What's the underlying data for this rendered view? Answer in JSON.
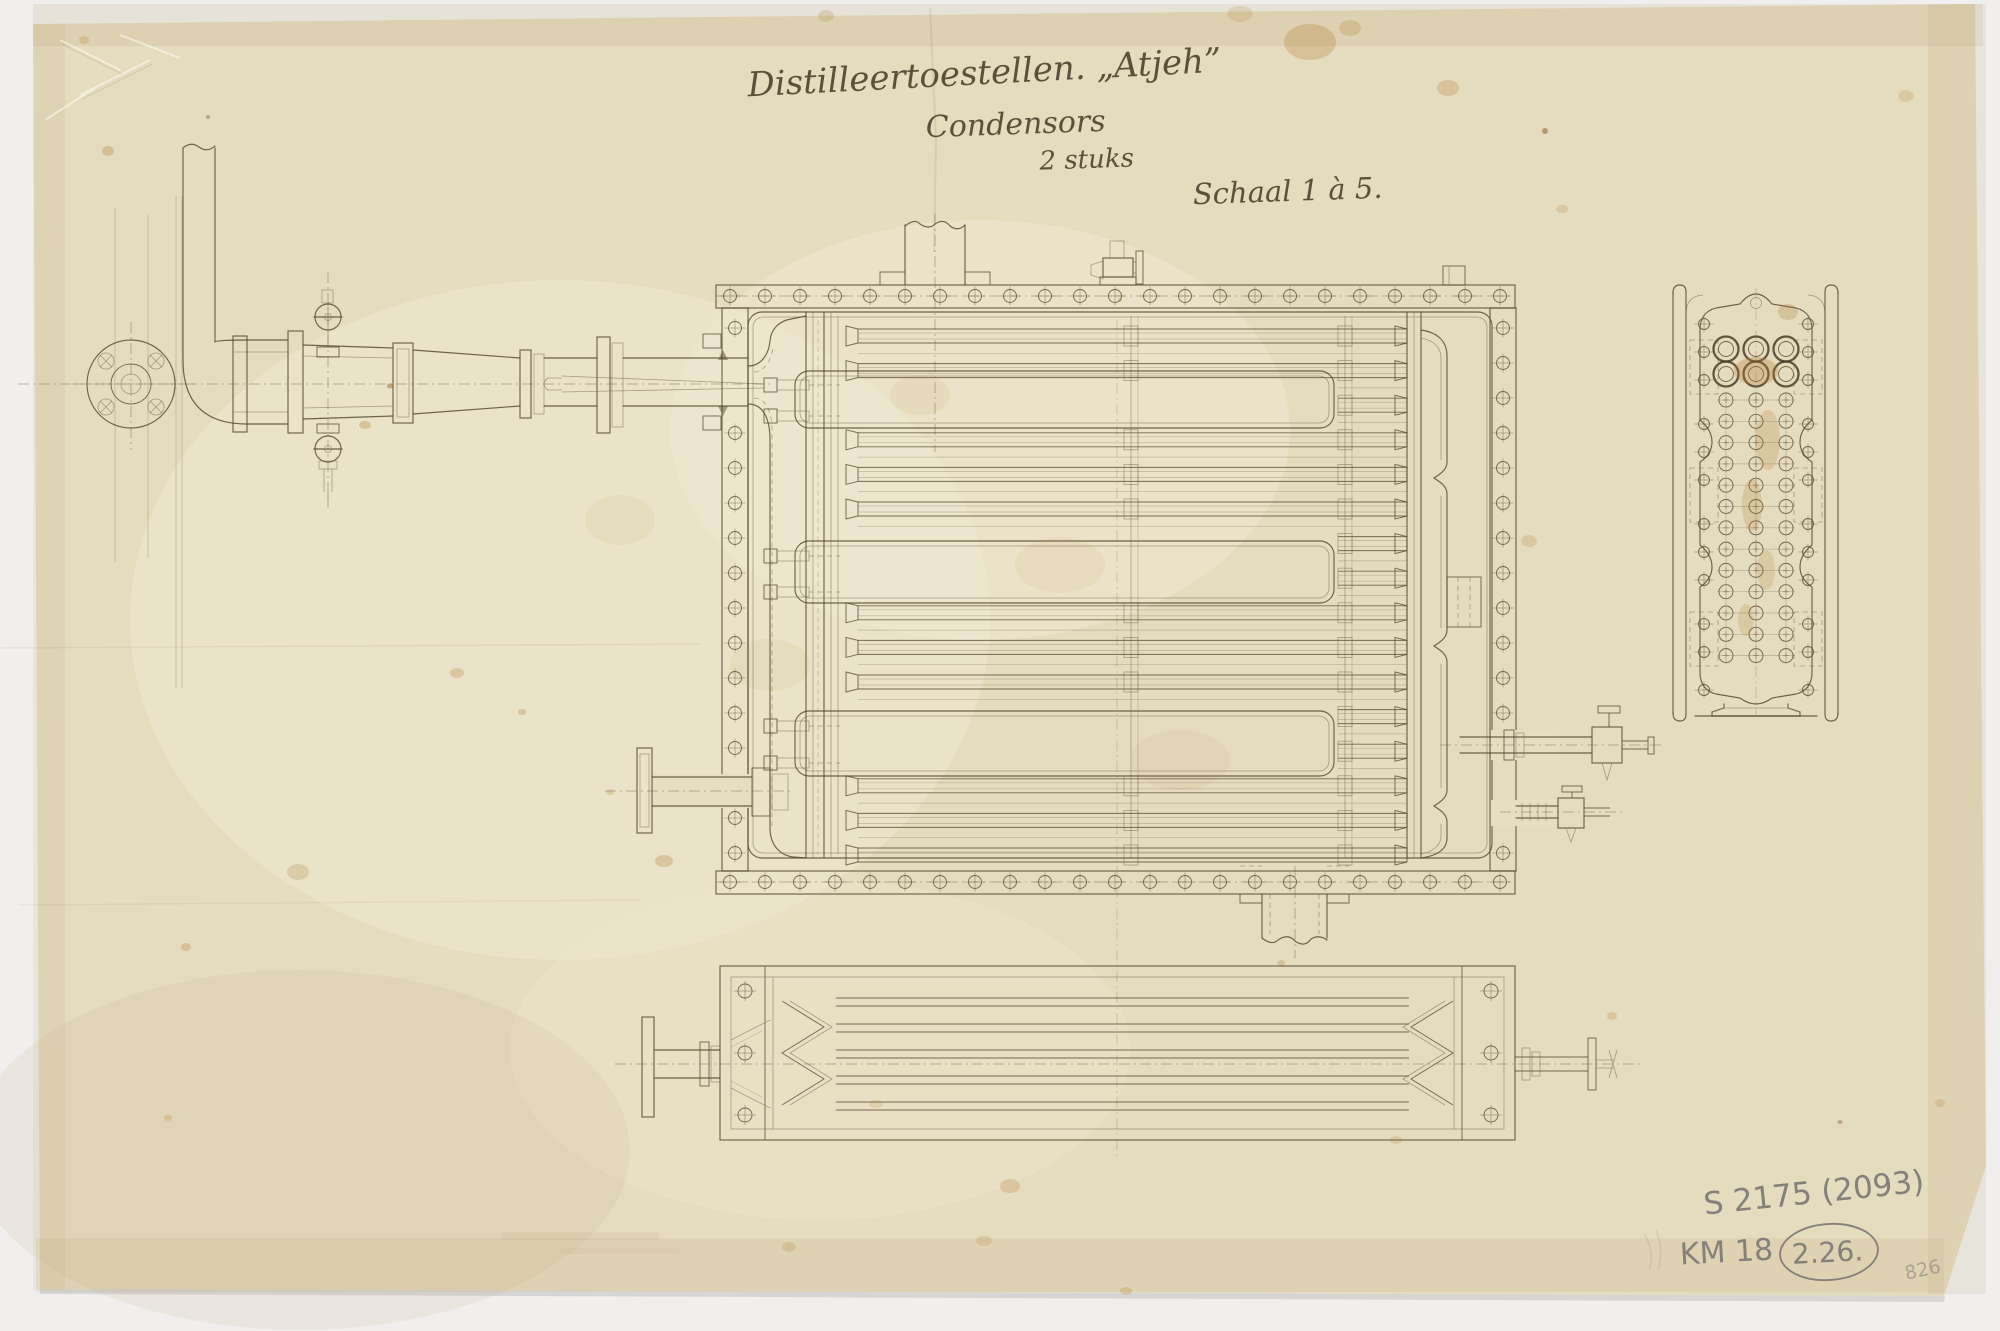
{
  "document": {
    "kind": "scanned technical drawing, aged paper",
    "title_line1": "Distilleertoestellen. „Atjeh”",
    "title_line2": "Condensors",
    "title_line3": "2 stuks",
    "scale_note": "Schaal 1 à 5.",
    "annotations": {
      "inventory_number": "S 2175 (2093)",
      "collection_mark": "KM 18",
      "circled_mark": "2.26.",
      "corner_number": "826"
    }
  },
  "colors": {
    "background": "#f0efed",
    "paper": "#e5dbbf",
    "ink": "#584a33",
    "ink_fine": "#6f6049",
    "pencil": "#84807a",
    "stain": "#b07a2e"
  },
  "drawing": {
    "flange_bolts": {
      "x0": 730,
      "step": 35,
      "count": 23,
      "y_top": 296,
      "y_bottom": 882,
      "r": 6.5
    },
    "wall_bolts": {
      "left_x": 735,
      "right_x": 1503,
      "r": 6.5,
      "left_ys": [
        328,
        433,
        468,
        503,
        538,
        573,
        608,
        643,
        678,
        713,
        748,
        818,
        853
      ],
      "right_ys": [
        328,
        363,
        398,
        433,
        468,
        503,
        538,
        573,
        608,
        643,
        678,
        713,
        853
      ]
    },
    "tubes": {
      "x0": 858,
      "x1": 1407,
      "y0": 336,
      "step": 34.6,
      "count": 16,
      "half_w": 7,
      "right_seg_x": 1338
    },
    "baffles": [
      [
        795,
        371,
        539,
        57
      ],
      [
        795,
        541,
        539,
        62
      ],
      [
        795,
        711,
        539,
        65
      ]
    ],
    "supports": {
      "cols": [
        1131,
        1345
      ]
    },
    "end_view": {
      "cols": [
        1726,
        1756,
        1786
      ],
      "big_rows": [
        349,
        374
      ],
      "big_r": 12.5,
      "big_r2": 7.5,
      "small_row_y0": 400,
      "small_row_step": 21.3,
      "small_rows": 13,
      "small_r": 7,
      "side_x": [
        1704,
        1808
      ],
      "side_ys": [
        324,
        352,
        380,
        424,
        452,
        480,
        524,
        552,
        580,
        624,
        652,
        690
      ],
      "pads_y": [
        [
          340,
          394
        ],
        [
          468,
          522
        ],
        [
          612,
          666
        ]
      ]
    },
    "plan": {
      "tube_pairs": [
        [
          998,
          1006
        ],
        [
          1024,
          1032
        ],
        [
          1050,
          1058
        ],
        [
          1076,
          1084
        ],
        [
          1102,
          1110
        ]
      ],
      "x0": 836,
      "x1": 1409,
      "bolts": [
        [
          745,
          991
        ],
        [
          745,
          1053
        ],
        [
          745,
          1115
        ],
        [
          1491,
          991
        ],
        [
          1491,
          1053
        ],
        [
          1491,
          1115
        ]
      ]
    },
    "stains": [
      [
        1310,
        42,
        26,
        18,
        0.28
      ],
      [
        1350,
        28,
        11,
        8,
        0.22
      ],
      [
        1240,
        14,
        13,
        8,
        0.18
      ],
      [
        826,
        16,
        8,
        6,
        0.2
      ],
      [
        1448,
        88,
        11,
        8,
        0.26
      ],
      [
        1906,
        96,
        8,
        6,
        0.18
      ],
      [
        1545,
        131,
        3,
        3,
        0.5
      ],
      [
        108,
        151,
        6,
        5,
        0.3
      ],
      [
        84,
        40,
        5,
        4,
        0.22
      ],
      [
        365,
        425,
        6,
        4,
        0.3
      ],
      [
        390,
        386,
        3,
        2.5,
        0.45
      ],
      [
        457,
        673,
        7,
        5,
        0.26
      ],
      [
        522,
        712,
        4,
        3,
        0.3
      ],
      [
        298,
        872,
        11,
        8,
        0.22
      ],
      [
        664,
        861,
        9,
        6,
        0.28
      ],
      [
        610,
        792,
        4,
        3,
        0.2
      ],
      [
        186,
        947,
        5,
        4,
        0.28
      ],
      [
        168,
        1118,
        4,
        3,
        0.22
      ],
      [
        1010,
        1186,
        10,
        7,
        0.24
      ],
      [
        789,
        1247,
        7,
        5,
        0.2
      ],
      [
        1126,
        1291,
        6,
        4,
        0.22
      ],
      [
        984,
        1241,
        8,
        5,
        0.18
      ],
      [
        876,
        1104,
        7,
        4,
        0.16
      ],
      [
        1281,
        963,
        4,
        3,
        0.24
      ],
      [
        1396,
        1140,
        6,
        4,
        0.18
      ],
      [
        1612,
        1016,
        5,
        4,
        0.2
      ],
      [
        1529,
        541,
        8,
        6,
        0.2
      ],
      [
        1562,
        209,
        6,
        4,
        0.18
      ],
      [
        1756,
        371,
        22,
        14,
        0.3
      ],
      [
        1768,
        440,
        12,
        30,
        0.2
      ],
      [
        1752,
        505,
        10,
        26,
        0.2
      ],
      [
        1766,
        570,
        9,
        20,
        0.18
      ],
      [
        1746,
        620,
        8,
        16,
        0.18
      ],
      [
        1788,
        312,
        10,
        8,
        0.25
      ],
      [
        1840,
        1122,
        2.5,
        2,
        0.4
      ],
      [
        1940,
        1103,
        5,
        4,
        0.2
      ],
      [
        920,
        395,
        30,
        20,
        0.08
      ],
      [
        1060,
        565,
        45,
        28,
        0.07
      ],
      [
        770,
        665,
        40,
        26,
        0.07
      ],
      [
        1180,
        760,
        50,
        30,
        0.06
      ],
      [
        620,
        520,
        35,
        25,
        0.07
      ],
      [
        208,
        117,
        2,
        2,
        0.4
      ],
      [
        1120,
        300,
        2,
        2,
        0.35
      ]
    ]
  }
}
